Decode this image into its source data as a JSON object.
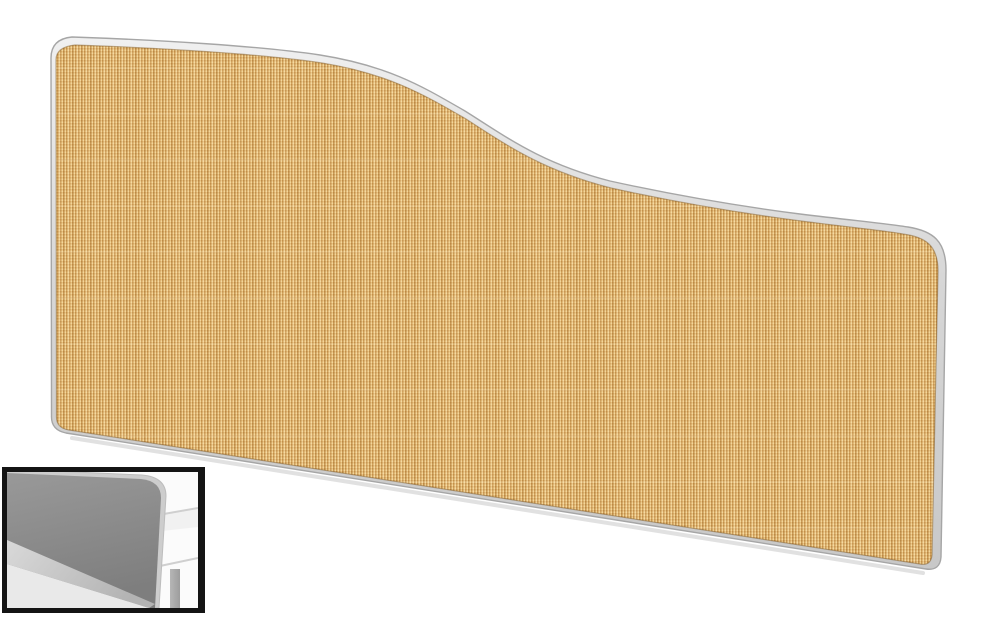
{
  "canvas": {
    "width": 1000,
    "height": 619,
    "background": "#ffffff"
  },
  "product_photo": {
    "label": "wave-top-desk-screen",
    "frame": {
      "fill_top": "#f0f0f0",
      "fill_mid": "#d7d7d7",
      "fill_bottom": "#c8c8c8",
      "edge": "#a6a6a6"
    },
    "fabric": {
      "base": "#dcae68",
      "weave_dark": "#c18f4a",
      "weave_light": "#f3d79c",
      "weave_mid_light": "#e8c07e",
      "weave_mid_dark": "#d3a35c",
      "stripe_dark": "rgba(140,90,30,0.10)",
      "stripe_light": "rgba(255,242,205,0.14)"
    },
    "ground_shadow": "rgba(110,110,110,0.35)"
  },
  "inset": {
    "label": "desk-mounted-preview",
    "border": "#141414",
    "background": "#fbfbfb",
    "screen_top": "#999999",
    "screen_bottom": "#7e7e7e",
    "screen_rim": "#cdcdcd",
    "desk_surface": "#f1f1f1",
    "desk_edge_line": "#cfcfcf",
    "desk_leg": "#b6b6b6",
    "desk_leg_shade": "#9d9d9d",
    "rail_light": "#d9d9d9",
    "rail_dark": "#b3b3b3",
    "front_panel": "#e9e9e9"
  }
}
